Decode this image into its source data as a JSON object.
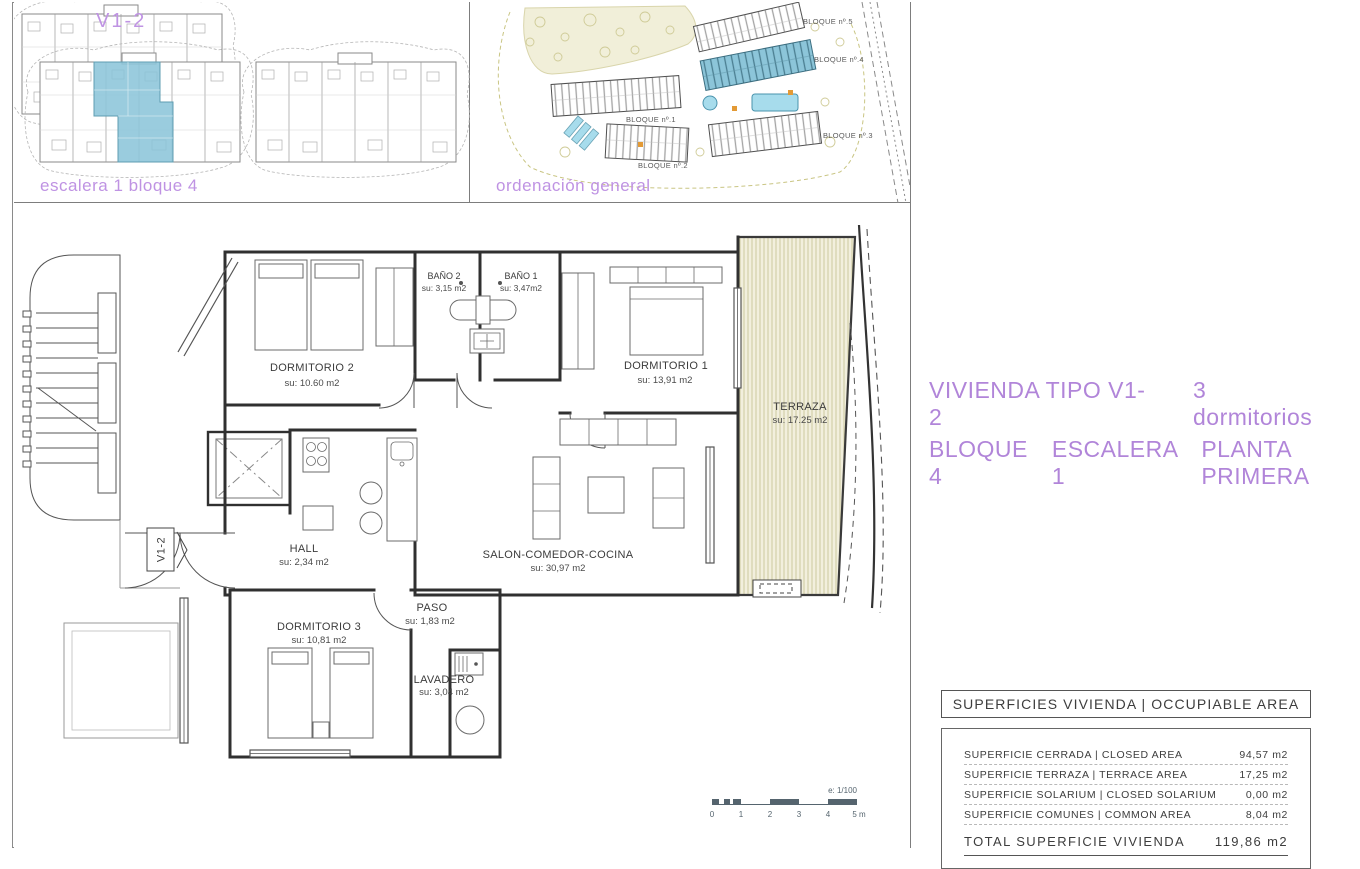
{
  "colors": {
    "accent_purple": "#b185d9",
    "caption_purple": "#bf93e3",
    "highlight_blue": "#8cc5d9",
    "terrace_beige": "#f2efdd",
    "scalebar_slate": "#55646e",
    "line_dark": "#303030"
  },
  "panel_unit": {
    "title": "V1-2",
    "caption": "escalera 1 bloque 4"
  },
  "panel_site": {
    "caption": "ordenación general",
    "labels": [
      "BLOQUE nº.5",
      "BLOQUE nº.4",
      "BLOQUE nº.1",
      "BLOQUE nº.2",
      "BLOQUE nº.3"
    ]
  },
  "title_block": {
    "type_label": "VIVIENDA TIPO V1-2",
    "bedrooms_label": "3 dormitorios",
    "block_label": "BLOQUE 4",
    "stair_label": "ESCALERA 1",
    "floor_label": "PLANTA PRIMERA"
  },
  "plan": {
    "marker": "V1-2",
    "rooms": [
      {
        "name": "DORMITORIO 2",
        "area": "su: 10.60 m2"
      },
      {
        "name": "BAÑO 2",
        "area": "su: 3,15 m2"
      },
      {
        "name": "BAÑO 1",
        "area": "su: 3,47m2"
      },
      {
        "name": "DORMITORIO 1",
        "area": "su: 13,91 m2"
      },
      {
        "name": "TERRAZA",
        "area": "su: 17.25 m2"
      },
      {
        "name": "HALL",
        "area": "su: 2,34 m2"
      },
      {
        "name": "SALON-COMEDOR-COCINA",
        "area": "su: 30,97 m2"
      },
      {
        "name": "PASO",
        "area": "su: 1,83 m2"
      },
      {
        "name": "DORMITORIO 3",
        "area": "su: 10,81 m2"
      },
      {
        "name": "LAVADERO",
        "area": "su: 3,04 m2"
      }
    ],
    "scalebar": {
      "scale_label": "e: 1/100",
      "ticks": [
        "0",
        "1",
        "2",
        "3",
        "4",
        "5 m"
      ]
    }
  },
  "areas_table": {
    "header": "SUPERFICIES VIVIENDA | OCCUPIABLE AREA",
    "rows": [
      {
        "label": "SUPERFICIE CERRADA | CLOSED AREA",
        "value": "94,57 m2"
      },
      {
        "label": "SUPERFICIE TERRAZA | TERRACE AREA",
        "value": "17,25 m2"
      },
      {
        "label": "SUPERFICIE SOLARIUM | CLOSED SOLARIUM",
        "value": "0,00 m2"
      },
      {
        "label": "SUPERFICIE COMUNES | COMMON AREA",
        "value": "8,04 m2"
      }
    ],
    "total_label": "TOTAL SUPERFICIE VIVIENDA",
    "total_value": "119,86 m2"
  }
}
